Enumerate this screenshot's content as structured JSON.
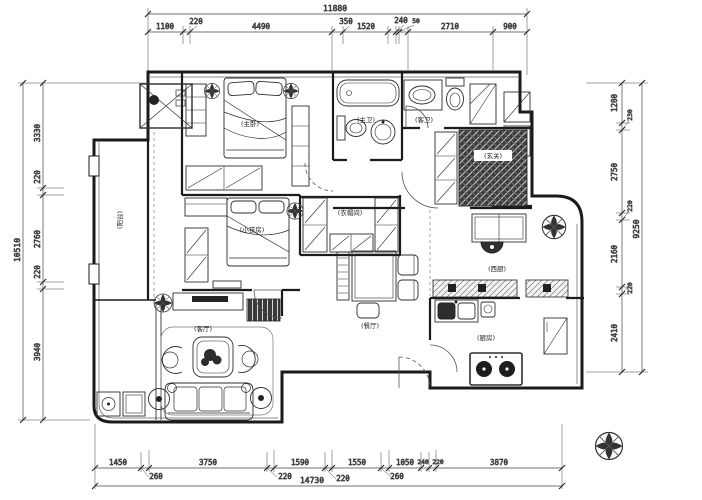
{
  "drawing": {
    "type": "residential-floor-plan",
    "colors": {
      "line": "#2e2e2e",
      "wall": "#1b1b1b",
      "dark_tile": "#383838",
      "paper": "#ffffff"
    }
  },
  "dims": {
    "top": {
      "overall": "11880",
      "segments": [
        "1100",
        "220",
        "4490",
        "350",
        "1520",
        "240",
        "50",
        "2710",
        "900"
      ]
    },
    "left": {
      "overall": "10510",
      "segments": [
        "3330",
        "220",
        "2760",
        "220",
        "3940"
      ]
    },
    "right": {
      "overall": "9250",
      "segments": [
        "1280",
        "230",
        "2750",
        "220",
        "2160",
        "220",
        "2410"
      ]
    },
    "bottom": {
      "overall": "14730",
      "segments": [
        "1450",
        "260",
        "3750",
        "220",
        "1590",
        "220",
        "1550",
        "260",
        "1050",
        "240",
        "220",
        "3870"
      ]
    }
  },
  "rooms": {
    "balcony": "(阳台)",
    "master_bedroom": "(主卧)",
    "master_bath": "(主卫)",
    "guest_bath": "(客卫)",
    "entry": "(玄关)",
    "closet": "(衣帽间)",
    "kids_room": "(小孩房)",
    "living_room": "(客厅)",
    "dining_room": "(餐厅)",
    "west_kitchen": "(西厨)",
    "kitchen": "(厨房)"
  }
}
